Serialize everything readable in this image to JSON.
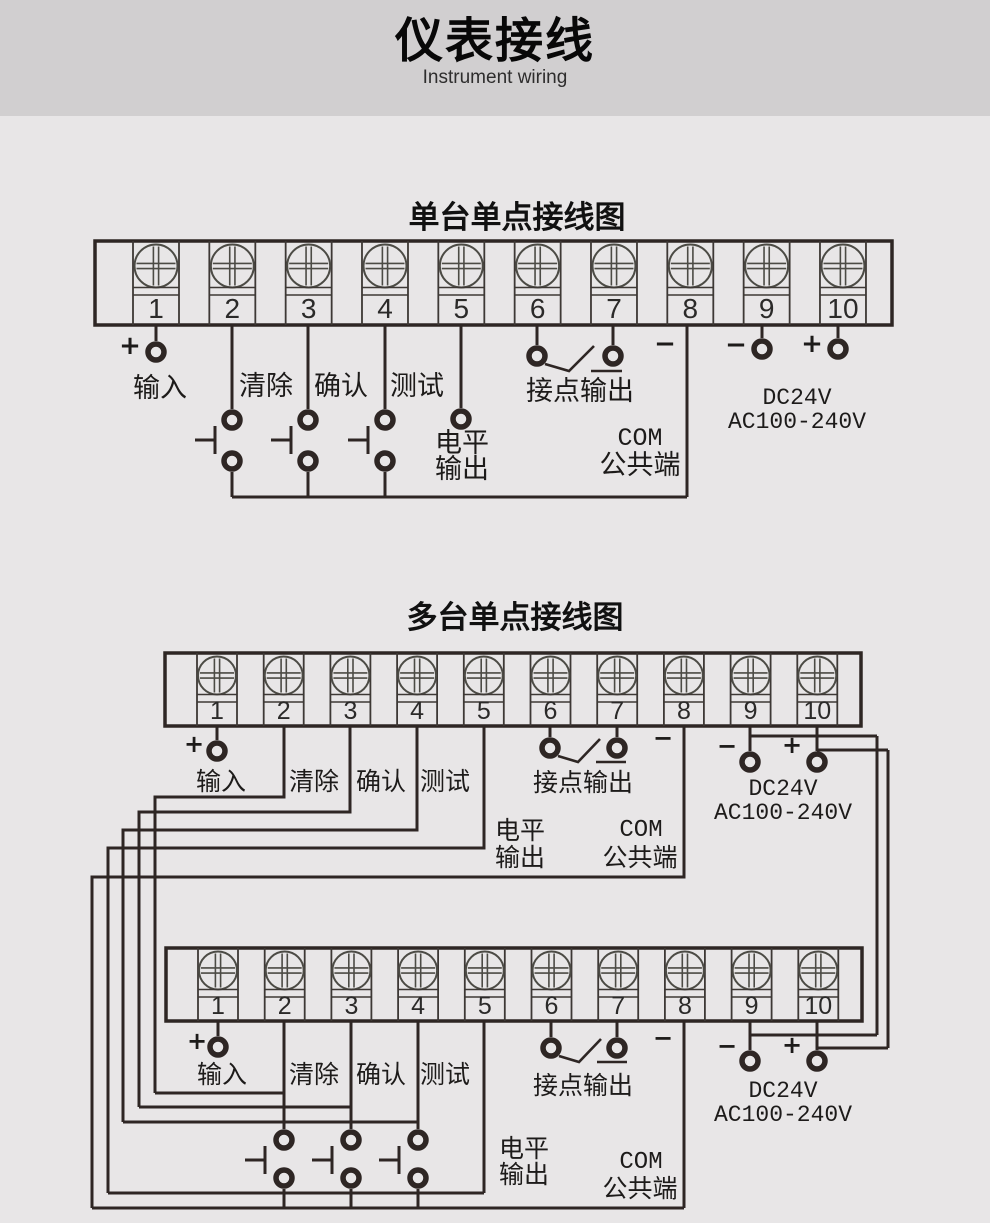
{
  "header": {
    "title": "仪表接线",
    "subtitle": "Instrument wiring"
  },
  "colors": {
    "header_band": "#d1cfd0",
    "background": "#e8e6e7",
    "line": "#2e2624"
  },
  "diagram_single": {
    "title": "单台单点接线图",
    "terminals": [
      "1",
      "2",
      "3",
      "4",
      "5",
      "6",
      "7",
      "8",
      "9",
      "10"
    ],
    "labels": {
      "input_plus": "+",
      "input": "输入",
      "clear": "清除",
      "confirm": "确认",
      "test": "测试",
      "level_line1": "电平",
      "level_line2": "输出",
      "contact_output": "接点输出",
      "com_minus": "−",
      "com": "COM",
      "com_common": "公共端",
      "power_minus": "−",
      "power_plus": "+",
      "power_dc": "DC24V",
      "power_ac": "AC100-240V"
    }
  },
  "diagram_multi": {
    "title": "多台单点接线图",
    "unit1": {
      "terminals": [
        "1",
        "2",
        "3",
        "4",
        "5",
        "6",
        "7",
        "8",
        "9",
        "10"
      ],
      "labels": {
        "input_plus": "+",
        "input": "输入",
        "clear": "清除",
        "confirm": "确认",
        "test": "测试",
        "level_line1": "电平",
        "level_line2": "输出",
        "contact_output": "接点输出",
        "com_minus": "−",
        "com": "COM",
        "com_common": "公共端",
        "power_minus": "−",
        "power_plus": "+",
        "power_dc": "DC24V",
        "power_ac": "AC100-240V"
      }
    },
    "unit2": {
      "terminals": [
        "1",
        "2",
        "3",
        "4",
        "5",
        "6",
        "7",
        "8",
        "9",
        "10"
      ],
      "labels": {
        "input_plus": "+",
        "input": "输入",
        "clear": "清除",
        "confirm": "确认",
        "test": "测试",
        "level_line1": "电平",
        "level_line2": "输出",
        "contact_output": "接点输出",
        "com_minus": "−",
        "com": "COM",
        "com_common": "公共端",
        "power_minus": "−",
        "power_plus": "+",
        "power_dc": "DC24V",
        "power_ac": "AC100-240V"
      }
    }
  }
}
